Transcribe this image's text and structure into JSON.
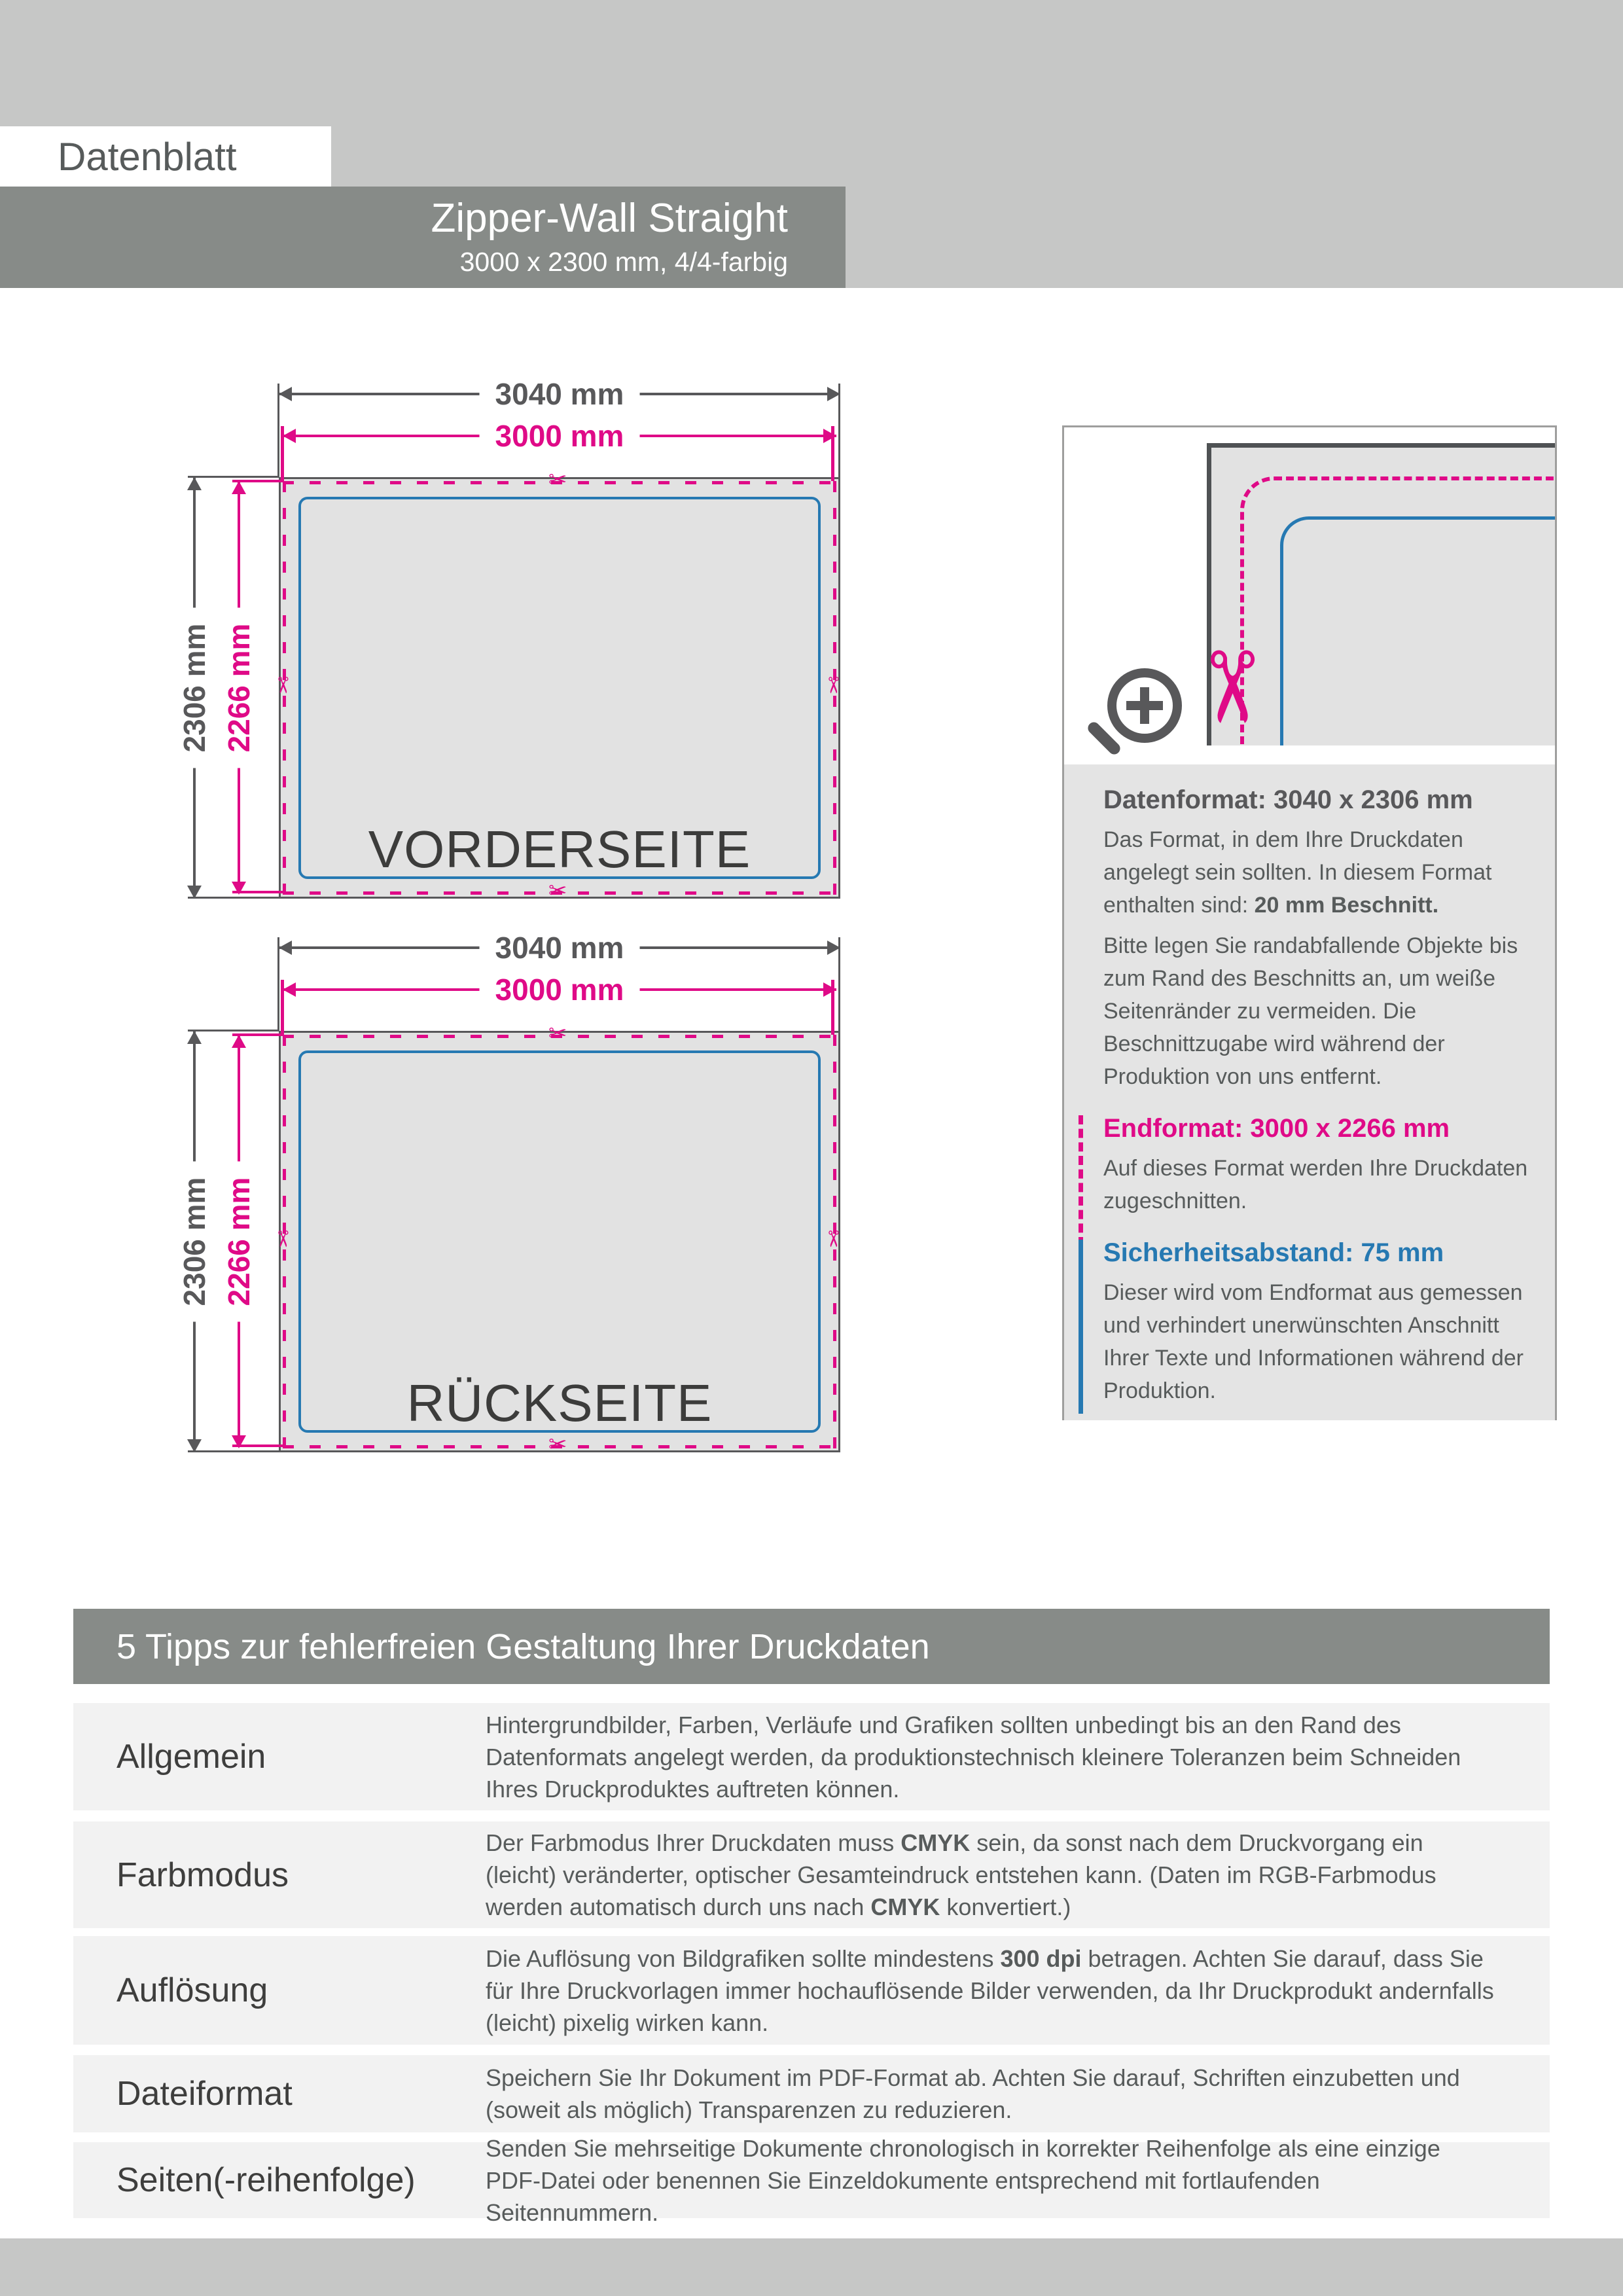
{
  "colors": {
    "accent_magenta": "#df0a87",
    "accent_blue": "#2679b2",
    "banner_gray": "#878b88",
    "header_gray": "#c6c7c6",
    "panel_gray": "#e4e4e4",
    "row_gray": "#f2f2f2",
    "line_dark_gray": "#58585a",
    "text_dark": "#3c3c3b",
    "text_body": "#575b5b"
  },
  "header": {
    "sheet_label": "Datenblatt",
    "product_title": "Zipper-Wall Straight",
    "product_subtitle": "3000 x 2300 mm, 4/4-farbig"
  },
  "dimensions": {
    "data_width": "3040 mm",
    "final_width": "3000 mm",
    "data_height": "2306 mm",
    "final_height": "2266 mm"
  },
  "diagrams": [
    {
      "label": "VORDERSEITE"
    },
    {
      "label": "RÜCKSEITE"
    }
  ],
  "icons": {
    "scissors_glyph": "✂",
    "magnifier": "magnifier-with-plus"
  },
  "panel": {
    "sections": [
      {
        "heading": "Datenformat: 3040 x 2306 mm",
        "paragraphs": [
          {
            "parts": [
              {
                "text": "Das Format, in dem Ihre Druckdaten angelegt sein sollten. In diesem Format enthalten sind: "
              },
              {
                "text": "20 mm Beschnitt.",
                "bold": true
              }
            ]
          },
          {
            "parts": [
              {
                "text": "Bitte legen Sie randabfallende Objekte bis zum Rand des Beschnitts an, um weiße Seitenränder zu vermeiden. Die Beschnittzugabe wird während der Produktion von uns entfernt."
              }
            ]
          }
        ]
      },
      {
        "heading": "Endformat: 3000 x 2266 mm",
        "paragraphs": [
          {
            "parts": [
              {
                "text": "Auf dieses Format werden Ihre Druckdaten zugeschnitten."
              }
            ]
          }
        ]
      },
      {
        "heading": "Sicherheitsabstand: 75 mm",
        "paragraphs": [
          {
            "parts": [
              {
                "text": "Dieser wird vom Endformat aus gemessen und verhindert unerwünschten Anschnitt Ihrer Texte und Informationen während der Produktion."
              }
            ]
          }
        ]
      }
    ]
  },
  "tips": {
    "title": "5 Tipps zur fehlerfreien Gestaltung Ihrer Druckdaten",
    "rows": [
      {
        "label": "Allgemein",
        "parts": [
          {
            "text": "Hintergrundbilder, Farben, Verläufe und Grafiken sollten unbedingt bis an den Rand des Datenformats angelegt werden, da produktionstechnisch kleinere Toleranzen beim Schneiden Ihres Druckproduktes auftreten können."
          }
        ]
      },
      {
        "label": "Farbmodus",
        "parts": [
          {
            "text": "Der Farbmodus Ihrer Druckdaten muss "
          },
          {
            "text": "CMYK",
            "bold": true
          },
          {
            "text": " sein, da sonst nach dem Druckvorgang ein (leicht) veränderter, optischer Gesamteindruck entstehen kann. (Daten im RGB-Farbmodus werden automatisch durch uns nach "
          },
          {
            "text": "CMYK",
            "bold": true
          },
          {
            "text": " konvertiert.)"
          }
        ]
      },
      {
        "label": "Auflösung",
        "parts": [
          {
            "text": "Die Auflösung von Bildgrafiken sollte mindestens "
          },
          {
            "text": "300 dpi",
            "bold": true
          },
          {
            "text": " betragen. Achten Sie darauf, dass Sie für Ihre Druckvorlagen immer hochauflösende Bilder verwenden, da Ihr Druckprodukt andernfalls (leicht) pixelig wirken kann."
          }
        ]
      },
      {
        "label": "Dateiformat",
        "parts": [
          {
            "text": "Speichern Sie Ihr Dokument im PDF-Format ab. Achten Sie darauf, Schriften einzubetten und (soweit als möglich) Transparenzen zu reduzieren."
          }
        ]
      },
      {
        "label": "Seiten(-reihenfolge)",
        "parts": [
          {
            "text": "Senden Sie mehrseitige Dokumente chronologisch in korrekter Reihenfolge als eine einzige PDF-Datei oder benennen Sie Einzeldokumente entsprechend mit fortlaufenden Seitennummern."
          }
        ]
      }
    ]
  }
}
